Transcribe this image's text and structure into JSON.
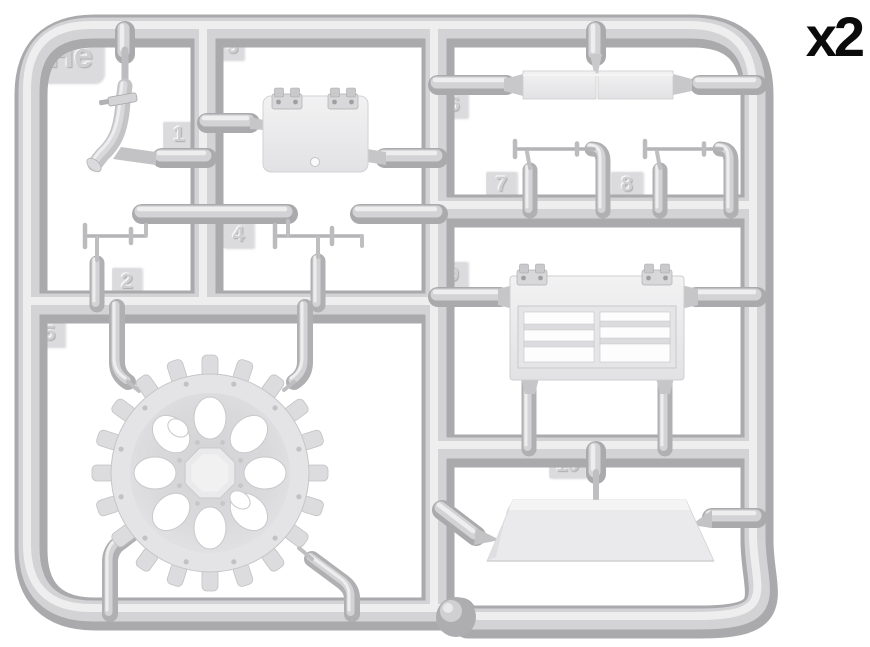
{
  "figure": {
    "type": "model-kit-sprue-diagram",
    "sprue_letter": "He",
    "quantity_label": "x2",
    "part_numbers": [
      "1",
      "2",
      "3",
      "4",
      "5",
      "6",
      "7",
      "8",
      "9",
      "10"
    ],
    "colors": {
      "background": "#ffffff",
      "plastic_base": "#aaaaac",
      "plastic_mid": "#d3d3d5",
      "plastic_highlight": "#eeeeef",
      "part_fill": "#ececee",
      "tag_fill": "#dbdbdd",
      "label_text": "#0b0b0b"
    }
  }
}
